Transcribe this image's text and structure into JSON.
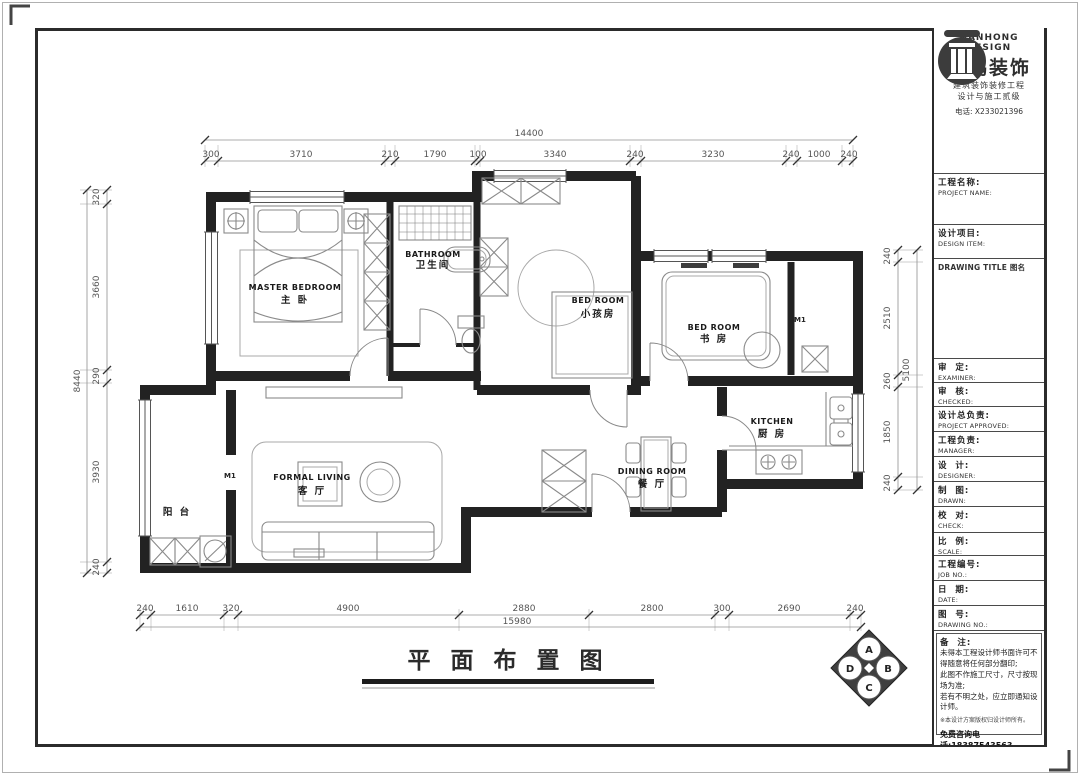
{
  "title_block": {
    "brand_en": "NANHONG DESIGN",
    "brand_cn": "南鸿装饰",
    "tagline1": "建筑装饰装修工程",
    "tagline2": "设计与施工贰级",
    "phone": "电话: X233021396",
    "fields": {
      "project_name": {
        "cn": "工程名称:",
        "en": "PROJECT NAME:"
      },
      "design_item": {
        "cn": "设计项目:",
        "en": "DESIGN ITEM:"
      },
      "drawing_title": {
        "cn": "DRAWING TITLE 图名"
      },
      "examiner": {
        "cn": "审  定:",
        "en": "EXAMINER:"
      },
      "checked": {
        "cn": "审  核:",
        "en": "CHECKED:"
      },
      "approved": {
        "cn": "设计总负责:",
        "en": "PROJECT APPROVED:"
      },
      "manager": {
        "cn": "工程负责:",
        "en": "MANAGER:"
      },
      "designer": {
        "cn": "设  计:",
        "en": "DESIGNER:"
      },
      "drawn": {
        "cn": "制  图:",
        "en": "DRAWN:"
      },
      "check": {
        "cn": "校  对:",
        "en": "CHECK:"
      },
      "scale": {
        "cn": "比  例:",
        "en": "SCALE:"
      },
      "job_no": {
        "cn": "工程编号:",
        "en": "JOB NO.:"
      },
      "date": {
        "cn": "日  期:",
        "en": "DATE:"
      },
      "drawing_no": {
        "cn": "图  号:",
        "en": "DRAWING NO.:"
      }
    },
    "notes": {
      "label": "备  注:",
      "line1": "未得本工程设计师书面许可不得随意将任何部分翻印;",
      "line2": "此图不作施工尺寸，尺寸按现场为准;",
      "line3": "若有不明之处，应立即通知设计师。",
      "line4": "※本设计方案版权归设计师所有。",
      "hotline": "免费咨询电话:18387543563"
    }
  },
  "plan": {
    "title": "平 面 布 置 图",
    "rooms": {
      "master": {
        "en": "MASTER BEDROOM",
        "cn": "主 卧"
      },
      "bathroom": {
        "en": "BATHROOM",
        "cn": "卫生间"
      },
      "kids": {
        "en": "BED ROOM",
        "cn": "小孩房"
      },
      "study": {
        "en": "BED ROOM",
        "cn": "书 房"
      },
      "kitchen": {
        "en": "KITCHEN",
        "cn": "厨 房"
      },
      "dining": {
        "en": "DINING ROOM",
        "cn": "餐 厅"
      },
      "living": {
        "en": "FORMAL LIVING",
        "cn": "客 厅"
      },
      "balcony": {
        "cn": "阳 台"
      }
    },
    "door_tags": {
      "study": "M1",
      "balcony": "M1"
    },
    "compass": {
      "top": "A",
      "right": "B",
      "bottom": "C",
      "left": "D"
    }
  },
  "dims": {
    "top": {
      "overall": "14400",
      "segments": [
        "300",
        "3710",
        "210",
        "1790",
        "100",
        "3340",
        "240",
        "3230",
        "240",
        "1000",
        "240"
      ]
    },
    "bottom": {
      "overall": "15980",
      "segments": [
        "240",
        "1610",
        "320",
        "4900",
        "2880",
        "2800",
        "300",
        "2690",
        "240"
      ]
    },
    "left": {
      "overall": "8440",
      "segments": [
        "320",
        "3660",
        "290",
        "3930",
        "240"
      ]
    },
    "right": {
      "overall": "5100",
      "segments": [
        "240",
        "2510",
        "260",
        "1850",
        "240"
      ]
    }
  }
}
